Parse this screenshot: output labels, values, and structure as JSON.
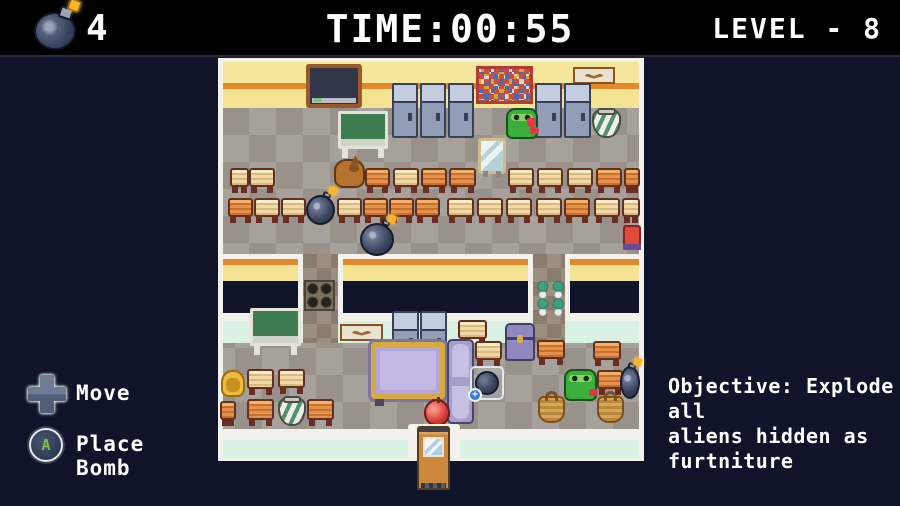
{
  "hud": {
    "bombs": {
      "icon": "bomb-icon",
      "count": "4"
    },
    "time": {
      "label": "TIME:00:55"
    },
    "level": {
      "label": "LEVEL - 8"
    }
  },
  "controls": {
    "move": {
      "icon": "dpad-icon",
      "label": "Move"
    },
    "place_bomb": {
      "icon": "a-button-icon",
      "button_letter": "A",
      "label": "Place Bomb"
    }
  },
  "objective": {
    "lines": [
      "Objective: Explode all",
      "aliens hidden as",
      "furtniture"
    ]
  },
  "colors": {
    "background": "#10142a",
    "header": "#000000",
    "wall_yellow": "#f2e493",
    "wall_stripe": "#e2892e",
    "wall_white": "#f2f1ec",
    "mint_band": "#d9f2e4",
    "floor_light": "#a7a19b",
    "floor_dark": "#98928b",
    "text": "#ffffff",
    "button_green": "#7cc046",
    "alien_green": "#3cae3c",
    "bomb_body": "#3c445e",
    "spark_orange": "#ffb32a"
  },
  "map": {
    "entities": [
      {
        "type": "blackboard",
        "x": 88,
        "y": 6,
        "w": 56,
        "h": 44
      },
      {
        "type": "poster",
        "x": 258,
        "y": 8,
        "w": 57,
        "h": 38
      },
      {
        "type": "sign",
        "x": 355,
        "y": 9,
        "w": 42,
        "h": 17
      },
      {
        "type": "locker",
        "x": 174,
        "y": 25,
        "w": 26,
        "h": 55
      },
      {
        "type": "locker",
        "x": 202,
        "y": 25,
        "w": 26,
        "h": 55
      },
      {
        "type": "locker",
        "x": 230,
        "y": 25,
        "w": 26,
        "h": 55
      },
      {
        "type": "locker",
        "x": 317,
        "y": 25,
        "w": 27,
        "h": 55
      },
      {
        "type": "locker",
        "x": 346,
        "y": 25,
        "w": 27,
        "h": 55
      },
      {
        "type": "alien",
        "x": 288,
        "y": 50,
        "w": 32,
        "h": 31
      },
      {
        "type": "heart",
        "x": 309,
        "y": 60,
        "w": 9,
        "h": 9
      },
      {
        "type": "pot",
        "x": 374,
        "y": 51,
        "w": 29,
        "h": 29
      },
      {
        "type": "greenboard",
        "x": 120,
        "y": 53,
        "w": 50,
        "h": 47
      },
      {
        "type": "mirror",
        "x": 260,
        "y": 80,
        "w": 28,
        "h": 36
      },
      {
        "type": "dog",
        "x": 116,
        "y": 101,
        "w": 31,
        "h": 29
      },
      {
        "type": "desk-light",
        "x": 12,
        "y": 110,
        "w": 19,
        "h": 25
      },
      {
        "type": "desk-light",
        "x": 31,
        "y": 110,
        "w": 26,
        "h": 25
      },
      {
        "type": "desk-orange",
        "x": 147,
        "y": 110,
        "w": 25,
        "h": 25
      },
      {
        "type": "desk-light",
        "x": 175,
        "y": 110,
        "w": 26,
        "h": 25
      },
      {
        "type": "desk-orange",
        "x": 203,
        "y": 110,
        "w": 26,
        "h": 25
      },
      {
        "type": "desk-orange",
        "x": 231,
        "y": 110,
        "w": 27,
        "h": 25
      },
      {
        "type": "desk-light",
        "x": 290,
        "y": 110,
        "w": 26,
        "h": 25
      },
      {
        "type": "desk-light",
        "x": 319,
        "y": 110,
        "w": 26,
        "h": 25
      },
      {
        "type": "desk-light",
        "x": 349,
        "y": 110,
        "w": 26,
        "h": 25
      },
      {
        "type": "desk-orange",
        "x": 378,
        "y": 110,
        "w": 26,
        "h": 25
      },
      {
        "type": "desk-orange",
        "x": 406,
        "y": 110,
        "w": 16,
        "h": 25
      },
      {
        "type": "desk-orange",
        "x": 10,
        "y": 140,
        "w": 25,
        "h": 25
      },
      {
        "type": "desk-light",
        "x": 36,
        "y": 140,
        "w": 26,
        "h": 25
      },
      {
        "type": "desk-light",
        "x": 63,
        "y": 140,
        "w": 25,
        "h": 25
      },
      {
        "type": "desk-light",
        "x": 119,
        "y": 140,
        "w": 25,
        "h": 25
      },
      {
        "type": "desk-orange",
        "x": 145,
        "y": 140,
        "w": 25,
        "h": 25
      },
      {
        "type": "desk-orange",
        "x": 171,
        "y": 140,
        "w": 25,
        "h": 25
      },
      {
        "type": "desk-orange",
        "x": 197,
        "y": 140,
        "w": 25,
        "h": 25
      },
      {
        "type": "desk-light",
        "x": 229,
        "y": 140,
        "w": 27,
        "h": 25
      },
      {
        "type": "desk-light",
        "x": 259,
        "y": 140,
        "w": 26,
        "h": 25
      },
      {
        "type": "desk-light",
        "x": 288,
        "y": 140,
        "w": 26,
        "h": 25
      },
      {
        "type": "desk-light",
        "x": 318,
        "y": 140,
        "w": 26,
        "h": 25
      },
      {
        "type": "desk-orange",
        "x": 346,
        "y": 140,
        "w": 26,
        "h": 25
      },
      {
        "type": "desk-light",
        "x": 376,
        "y": 140,
        "w": 26,
        "h": 25
      },
      {
        "type": "desk-light",
        "x": 404,
        "y": 140,
        "w": 18,
        "h": 25
      },
      {
        "type": "bomb",
        "x": 88,
        "y": 137,
        "w": 29,
        "h": 30
      },
      {
        "type": "bomb",
        "x": 142,
        "y": 165,
        "w": 34,
        "h": 33
      },
      {
        "type": "red-chair",
        "x": 405,
        "y": 167,
        "w": 18,
        "h": 25
      },
      {
        "type": "pot-grid",
        "x": 86,
        "y": 222,
        "w": 31,
        "h": 31
      },
      {
        "type": "plant-grid",
        "x": 317,
        "y": 223,
        "w": 31,
        "h": 35
      },
      {
        "type": "greenboard",
        "x": 32,
        "y": 250,
        "w": 51,
        "h": 47
      },
      {
        "type": "sign",
        "x": 122,
        "y": 266,
        "w": 43,
        "h": 17
      },
      {
        "type": "locker",
        "x": 174,
        "y": 253,
        "w": 27,
        "h": 49
      },
      {
        "type": "locker",
        "x": 202,
        "y": 253,
        "w": 27,
        "h": 49
      },
      {
        "type": "desk-light",
        "x": 240,
        "y": 262,
        "w": 29,
        "h": 25
      },
      {
        "type": "chest",
        "x": 287,
        "y": 265,
        "w": 30,
        "h": 38
      },
      {
        "type": "purple-table",
        "x": 150,
        "y": 281,
        "w": 80,
        "h": 63
      },
      {
        "type": "purple-cabinet",
        "x": 229,
        "y": 281,
        "w": 27,
        "h": 85
      },
      {
        "type": "desk-light",
        "x": 257,
        "y": 283,
        "w": 27,
        "h": 25
      },
      {
        "type": "desk-orange",
        "x": 319,
        "y": 282,
        "w": 28,
        "h": 25
      },
      {
        "type": "desk-orange",
        "x": 375,
        "y": 283,
        "w": 28,
        "h": 25
      },
      {
        "type": "bomb-pickup",
        "x": 252,
        "y": 308,
        "w": 34,
        "h": 34
      },
      {
        "type": "alien",
        "x": 346,
        "y": 311,
        "w": 33,
        "h": 32
      },
      {
        "type": "desk-orange",
        "x": 379,
        "y": 312,
        "w": 26,
        "h": 25
      },
      {
        "type": "bomb",
        "x": 402,
        "y": 308,
        "w": 20,
        "h": 33
      },
      {
        "type": "yellow-bed",
        "x": 3,
        "y": 312,
        "w": 24,
        "h": 27
      },
      {
        "type": "desk-light",
        "x": 29,
        "y": 311,
        "w": 27,
        "h": 26
      },
      {
        "type": "desk-light",
        "x": 60,
        "y": 311,
        "w": 27,
        "h": 25
      },
      {
        "type": "desk-orange",
        "x": 2,
        "y": 343,
        "w": 16,
        "h": 25
      },
      {
        "type": "desk-orange",
        "x": 29,
        "y": 341,
        "w": 27,
        "h": 27
      },
      {
        "type": "pot",
        "x": 60,
        "y": 339,
        "w": 28,
        "h": 29
      },
      {
        "type": "desk-orange",
        "x": 89,
        "y": 341,
        "w": 27,
        "h": 27
      },
      {
        "type": "apple",
        "x": 206,
        "y": 341,
        "w": 26,
        "h": 27
      },
      {
        "type": "basket",
        "x": 320,
        "y": 338,
        "w": 27,
        "h": 27
      },
      {
        "type": "basket",
        "x": 379,
        "y": 338,
        "w": 27,
        "h": 27
      },
      {
        "type": "door-frame",
        "x": 190,
        "y": 366,
        "w": 52,
        "h": 37
      },
      {
        "type": "door",
        "x": 199,
        "y": 368,
        "w": 33,
        "h": 64
      }
    ]
  }
}
